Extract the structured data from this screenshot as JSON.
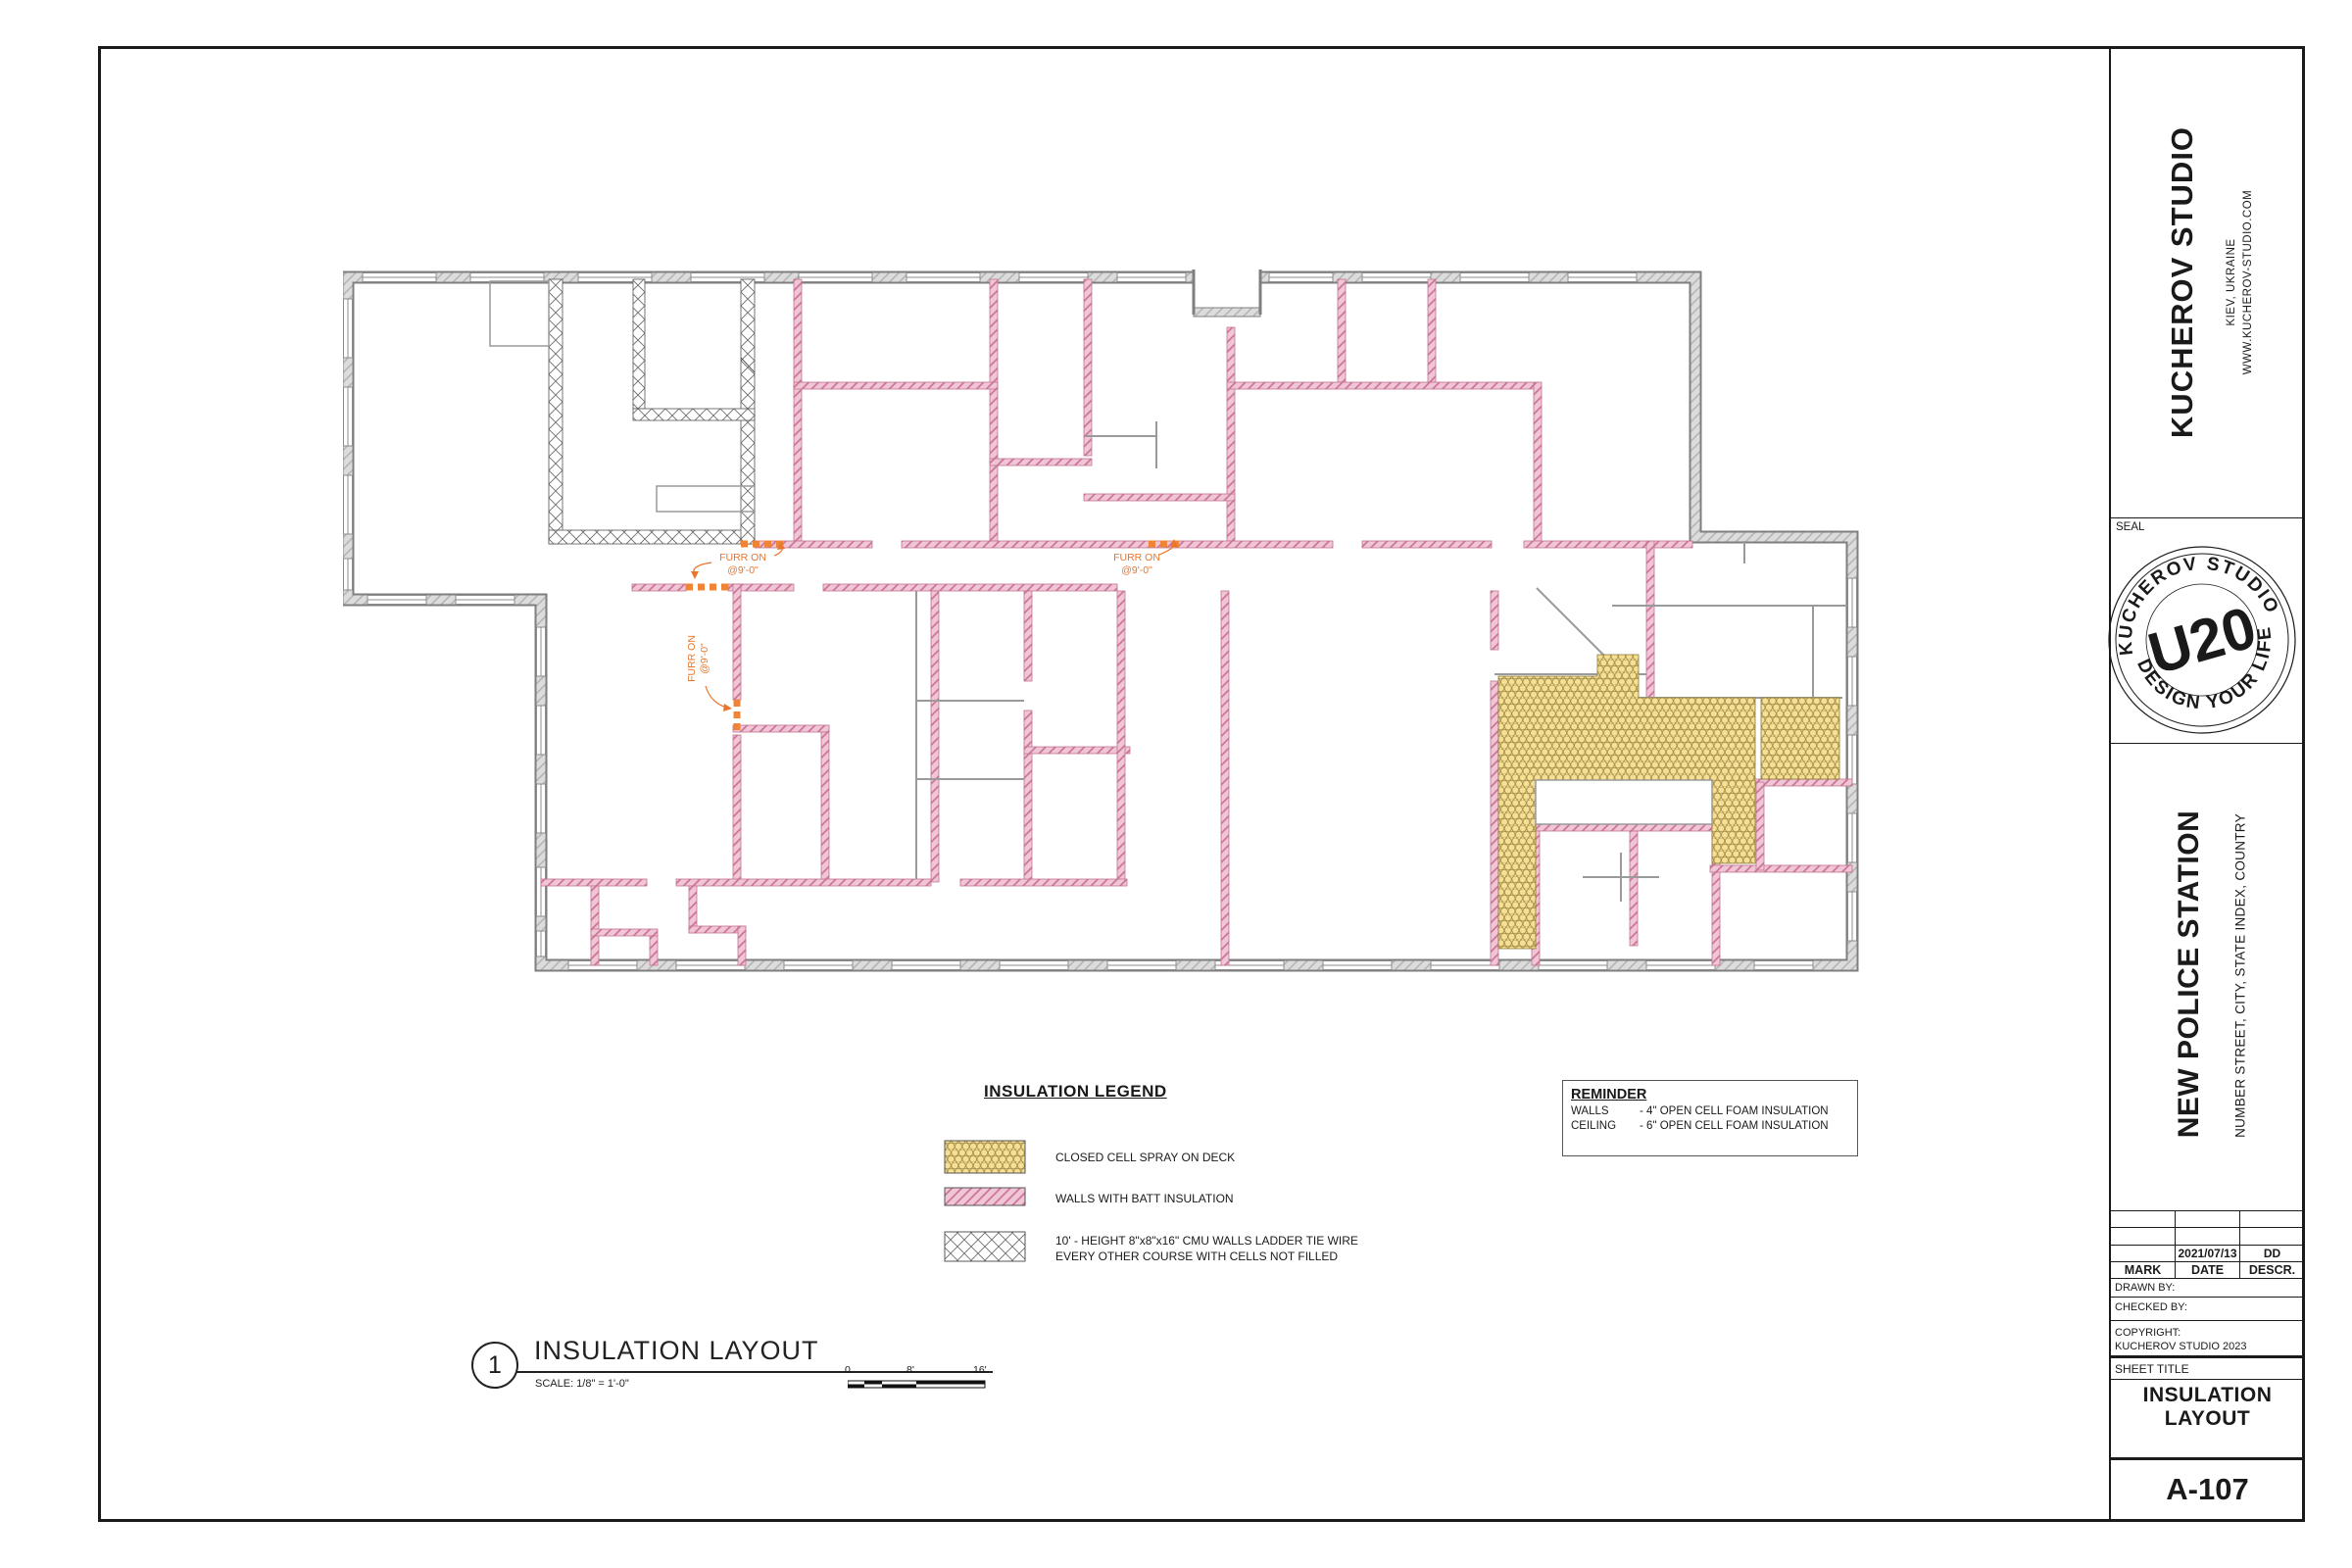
{
  "studio": {
    "name": "KUCHEROV STUDIO",
    "location": "KIEV, UKRAINE",
    "website": "WWW.KUCHEROV-STUDIO.COM",
    "seal_label": "SEAL",
    "seal": {
      "arc_top": "KUCHEROV STUDIO",
      "center": "U20",
      "arc_bottom": "DESIGN YOUR LIFE"
    }
  },
  "project": {
    "name": "NEW POLICE STATION",
    "address": "NUMBER STREET, CITY, STATE INDEX, COUNTRY"
  },
  "revisions": {
    "headers": [
      "MARK",
      "DATE",
      "DESCR."
    ],
    "entry": {
      "mark": "",
      "date": "2021/07/13",
      "descr": "DD"
    }
  },
  "signoff": {
    "drawn_by": "DRAWN BY:",
    "checked_by": "CHECKED BY:",
    "copyright_label": "COPYRIGHT:",
    "copyright": "KUCHEROV STUDIO 2023"
  },
  "sheet": {
    "title_label": "SHEET TITLE",
    "title": "INSULATION LAYOUT",
    "number": "A-107"
  },
  "drawing": {
    "number": "1",
    "title": "INSULATION LAYOUT",
    "scale": "SCALE:   1/8\" = 1'-0\"",
    "scale_ticks": [
      "0",
      "8'",
      "16'"
    ]
  },
  "legend": {
    "title": "INSULATION LEGEND",
    "items": [
      {
        "key": "closed-cell-spray",
        "label": "CLOSED CELL SPRAY ON DECK"
      },
      {
        "key": "batt-insulation",
        "label": "WALLS WITH BATT INSULATION"
      },
      {
        "key": "cmu-walls",
        "label": "10' - HEIGHT 8\"x8\"x16\" CMU WALLS LADDER TIE WIRE",
        "label2": "EVERY OTHER COURSE WITH CELLS NOT FILLED"
      }
    ]
  },
  "reminder": {
    "title": "REMINDER",
    "rows": [
      {
        "item": "WALLS",
        "spec": "- 4\" OPEN CELL FOAM INSULATION"
      },
      {
        "item": "CEILING",
        "spec": "- 6\" OPEN CELL FOAM INSULATION"
      }
    ]
  },
  "plan": {
    "furr_line1": "FURR ON",
    "furr_line2": "@9'-0\"",
    "colors": {
      "batt_pink": "#f0c6d6",
      "batt_hatch": "#c96d93",
      "spray_yellow": "#f6df95",
      "spray_ring": "#a8934d",
      "wall_gray": "#dcdcdc",
      "furr_orange": "#e8762c"
    }
  }
}
